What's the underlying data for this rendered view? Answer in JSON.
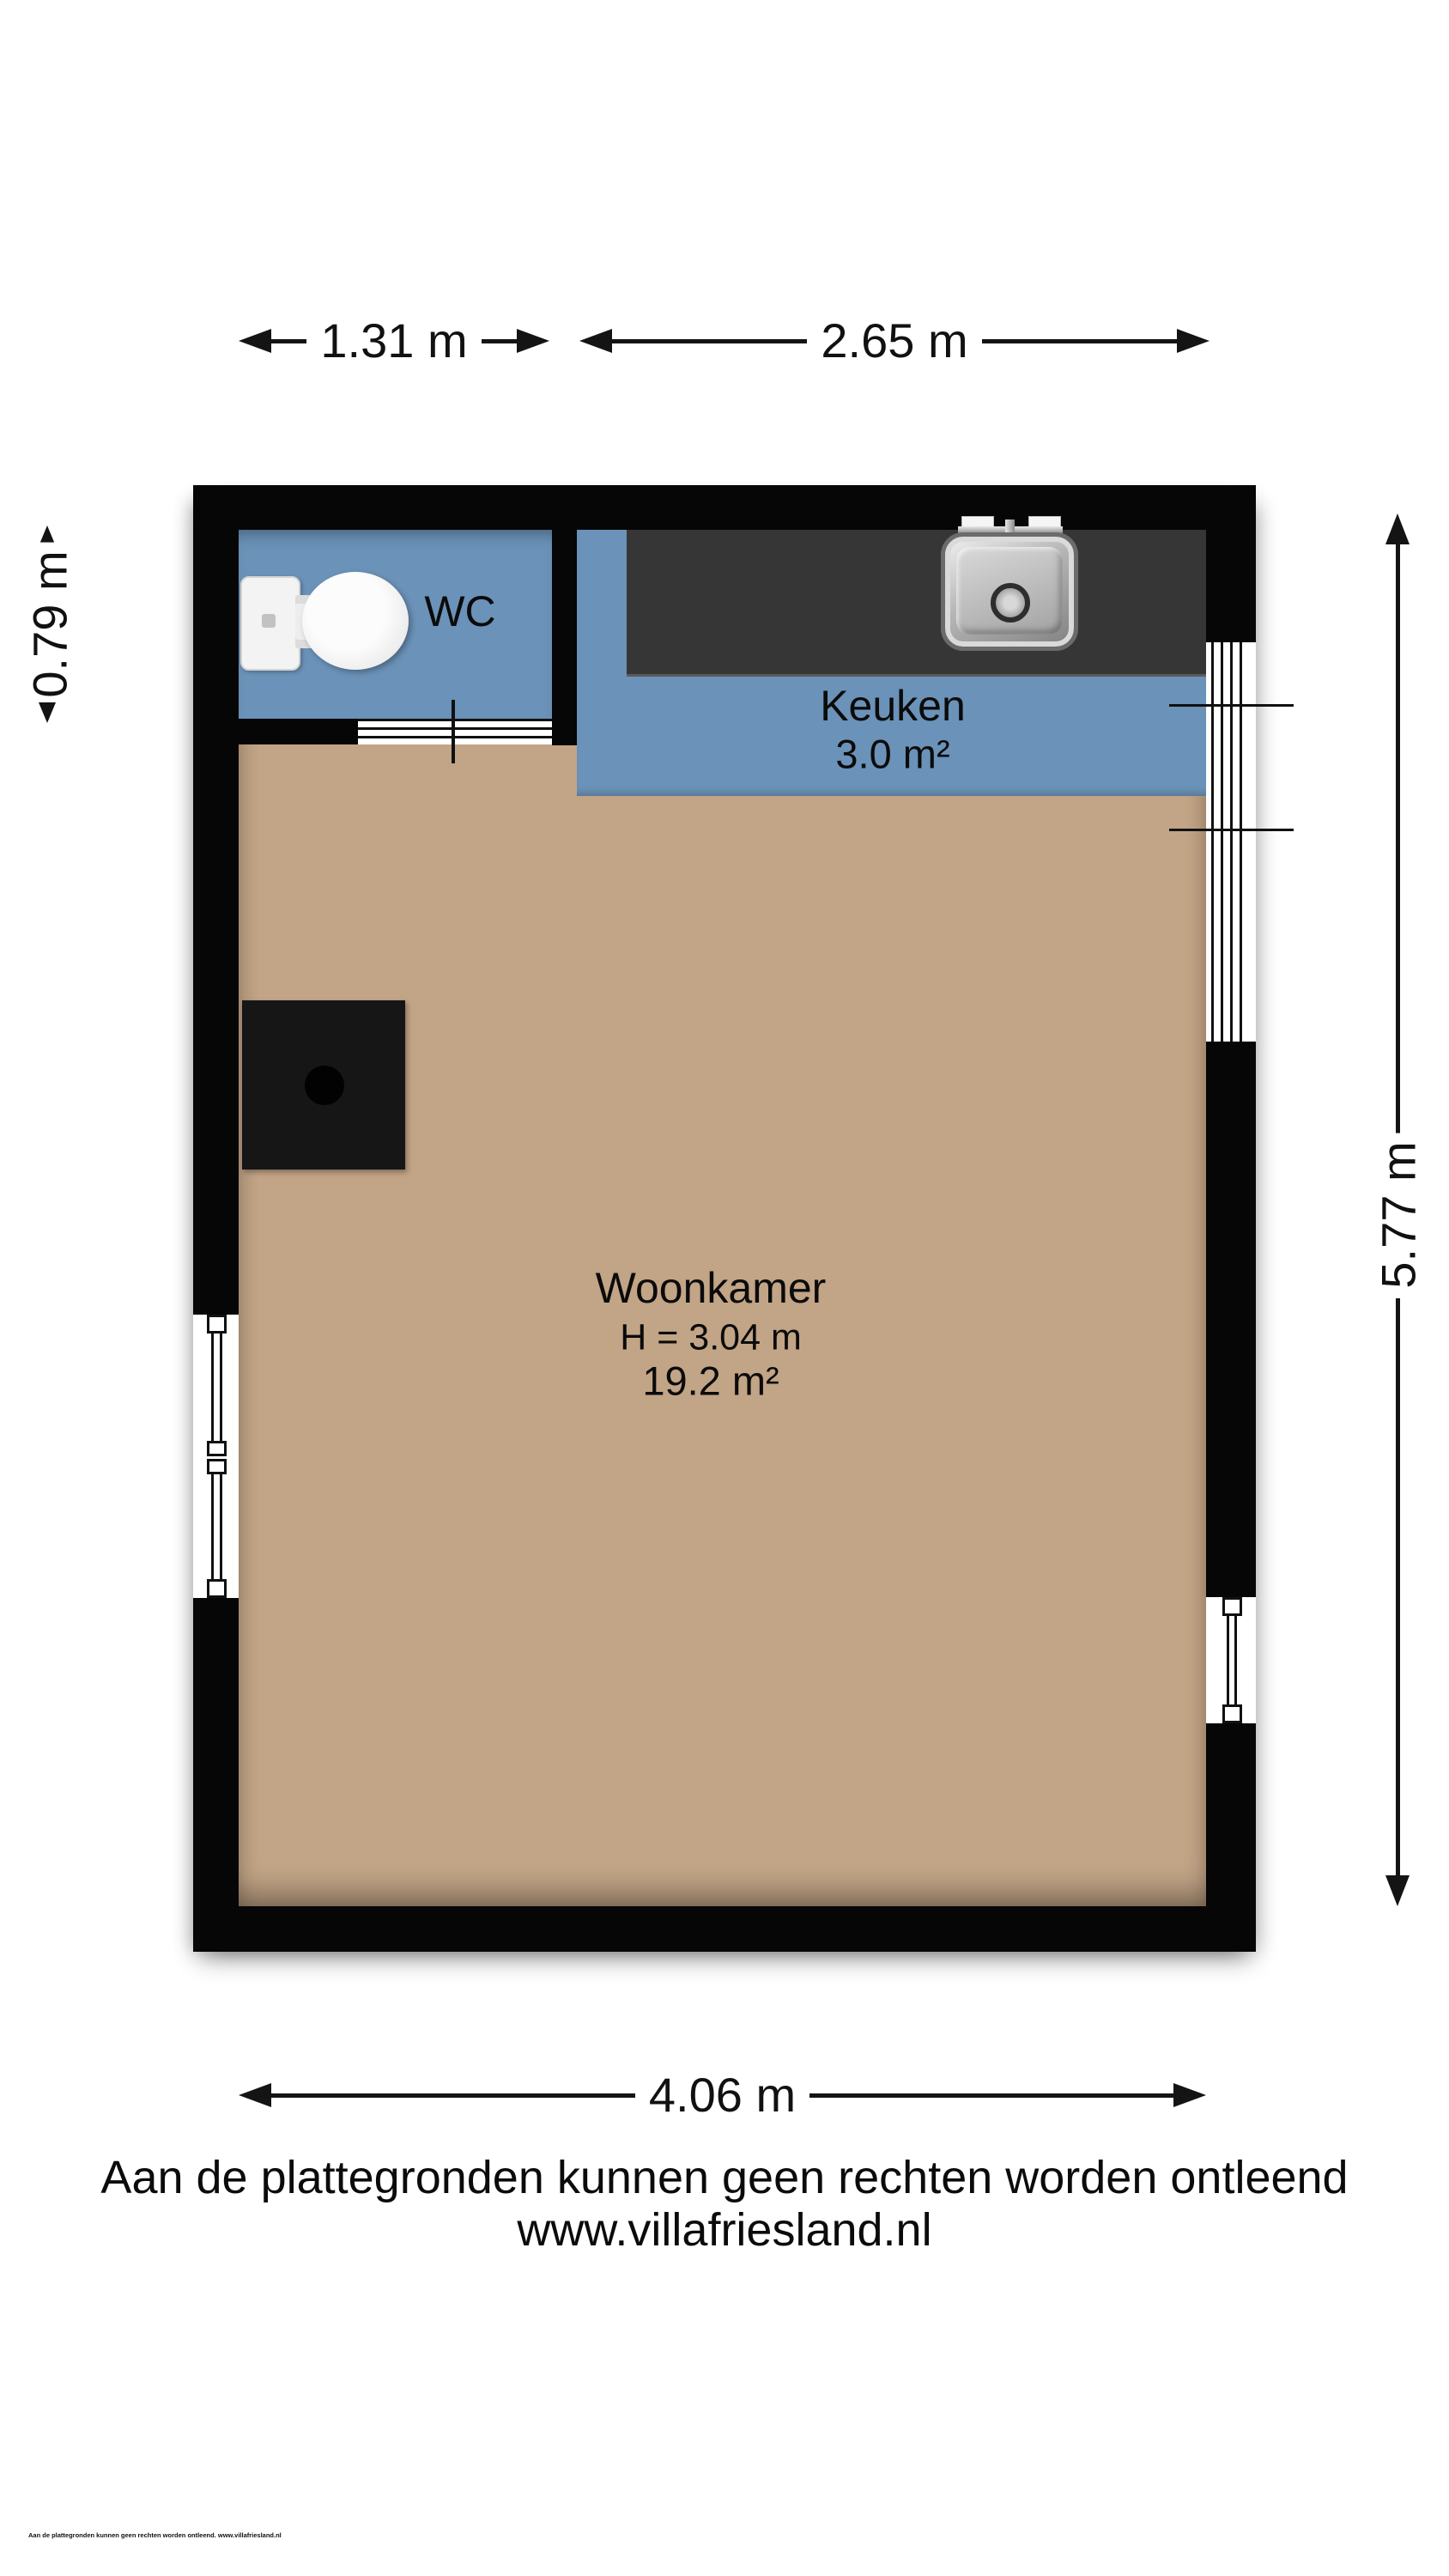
{
  "dimensions": {
    "top_wc_width": "1.31 m",
    "top_kitchen_width": "2.65 m",
    "left_wc_depth": "0.79 m",
    "right_height": "5.77 m",
    "bottom_width": "4.06 m"
  },
  "rooms": {
    "wc": {
      "name": "WC"
    },
    "kitchen": {
      "name": "Keuken",
      "area": "3.0 m²"
    },
    "living": {
      "name": "Woonkamer",
      "ceiling_height": "H = 3.04 m",
      "area": "19.2 m²"
    }
  },
  "footer": {
    "disclaimer": "Aan de plattegronden kunnen geen rechten worden ontleend",
    "website": "www.villafriesland.nl",
    "fine_print": "Aan de plattegronden kunnen geen rechten worden ontleend. www.villafriesland.nl"
  },
  "icons": {
    "toilet": "toilet-top-view-icon",
    "sink": "kitchen-sink-icon",
    "fireplace": "stove-square-icon",
    "windows": "window-symbol",
    "door": "sliding-door-symbol"
  },
  "colors": {
    "wall": "#060606",
    "wet_floor": "#6b92b8",
    "living_floor": "#c2a486",
    "counter": "#363636",
    "dimension_lines": "#141414"
  }
}
